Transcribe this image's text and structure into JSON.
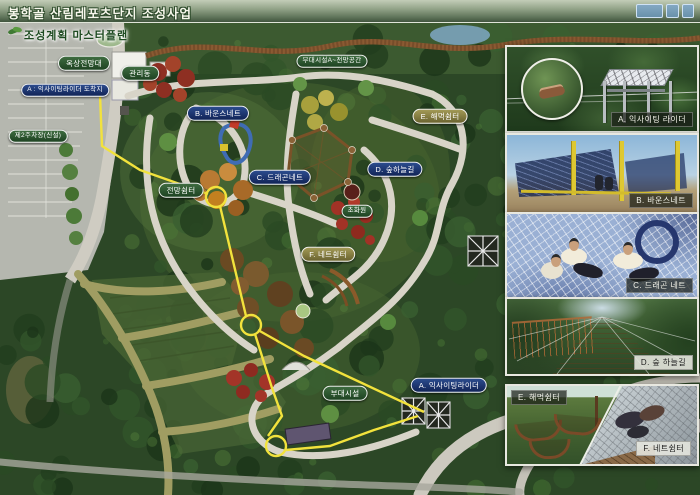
{
  "header": {
    "title": "봉학골 산림레포츠단지 조성사업"
  },
  "plan": {
    "subtitle": "조성계획 마스터플랜",
    "facility_labels": [
      {
        "text": "옥상전망대"
      },
      {
        "text": "관리동"
      },
      {
        "text": "부대시설A~전망공간"
      },
      {
        "text": "전망쉼터"
      },
      {
        "text": "초화원"
      },
      {
        "text": "부대시설"
      },
      {
        "text": "제2주차장(신설)"
      }
    ],
    "activity_labels": [
      {
        "text": "A : 익사이팅라이더 도착지"
      },
      {
        "text": "B. 바운스네트"
      },
      {
        "text": "C. 드래곤네트"
      },
      {
        "text": "D. 숲하늘길"
      },
      {
        "text": "A. 익사이팅라이더"
      }
    ],
    "rest_labels": [
      {
        "text": "E. 해먹쉼터"
      },
      {
        "text": "F. 네트쉼터"
      }
    ]
  },
  "photos": [
    {
      "id": "A",
      "label": "A. 익사이팅 라이더"
    },
    {
      "id": "B",
      "label": "B. 바운스네트"
    },
    {
      "id": "C",
      "label": "C. 드래곤 네트"
    },
    {
      "id": "D",
      "label": "D. 숲 하늘길"
    },
    {
      "id": "E",
      "label": "E. 해먹쉼터"
    },
    {
      "id": "F",
      "label": "F. 네트쉼터"
    }
  ],
  "icons": {
    "sprout": "leaf-sprout-icon",
    "county_logo": "county-emblem-icon"
  },
  "colors": {
    "pill_navy": "#122457",
    "pill_green": "#1e4322",
    "pill_khaki": "#6a6330",
    "route_yellow": "#f2e23c",
    "header_green": "#41543e"
  }
}
